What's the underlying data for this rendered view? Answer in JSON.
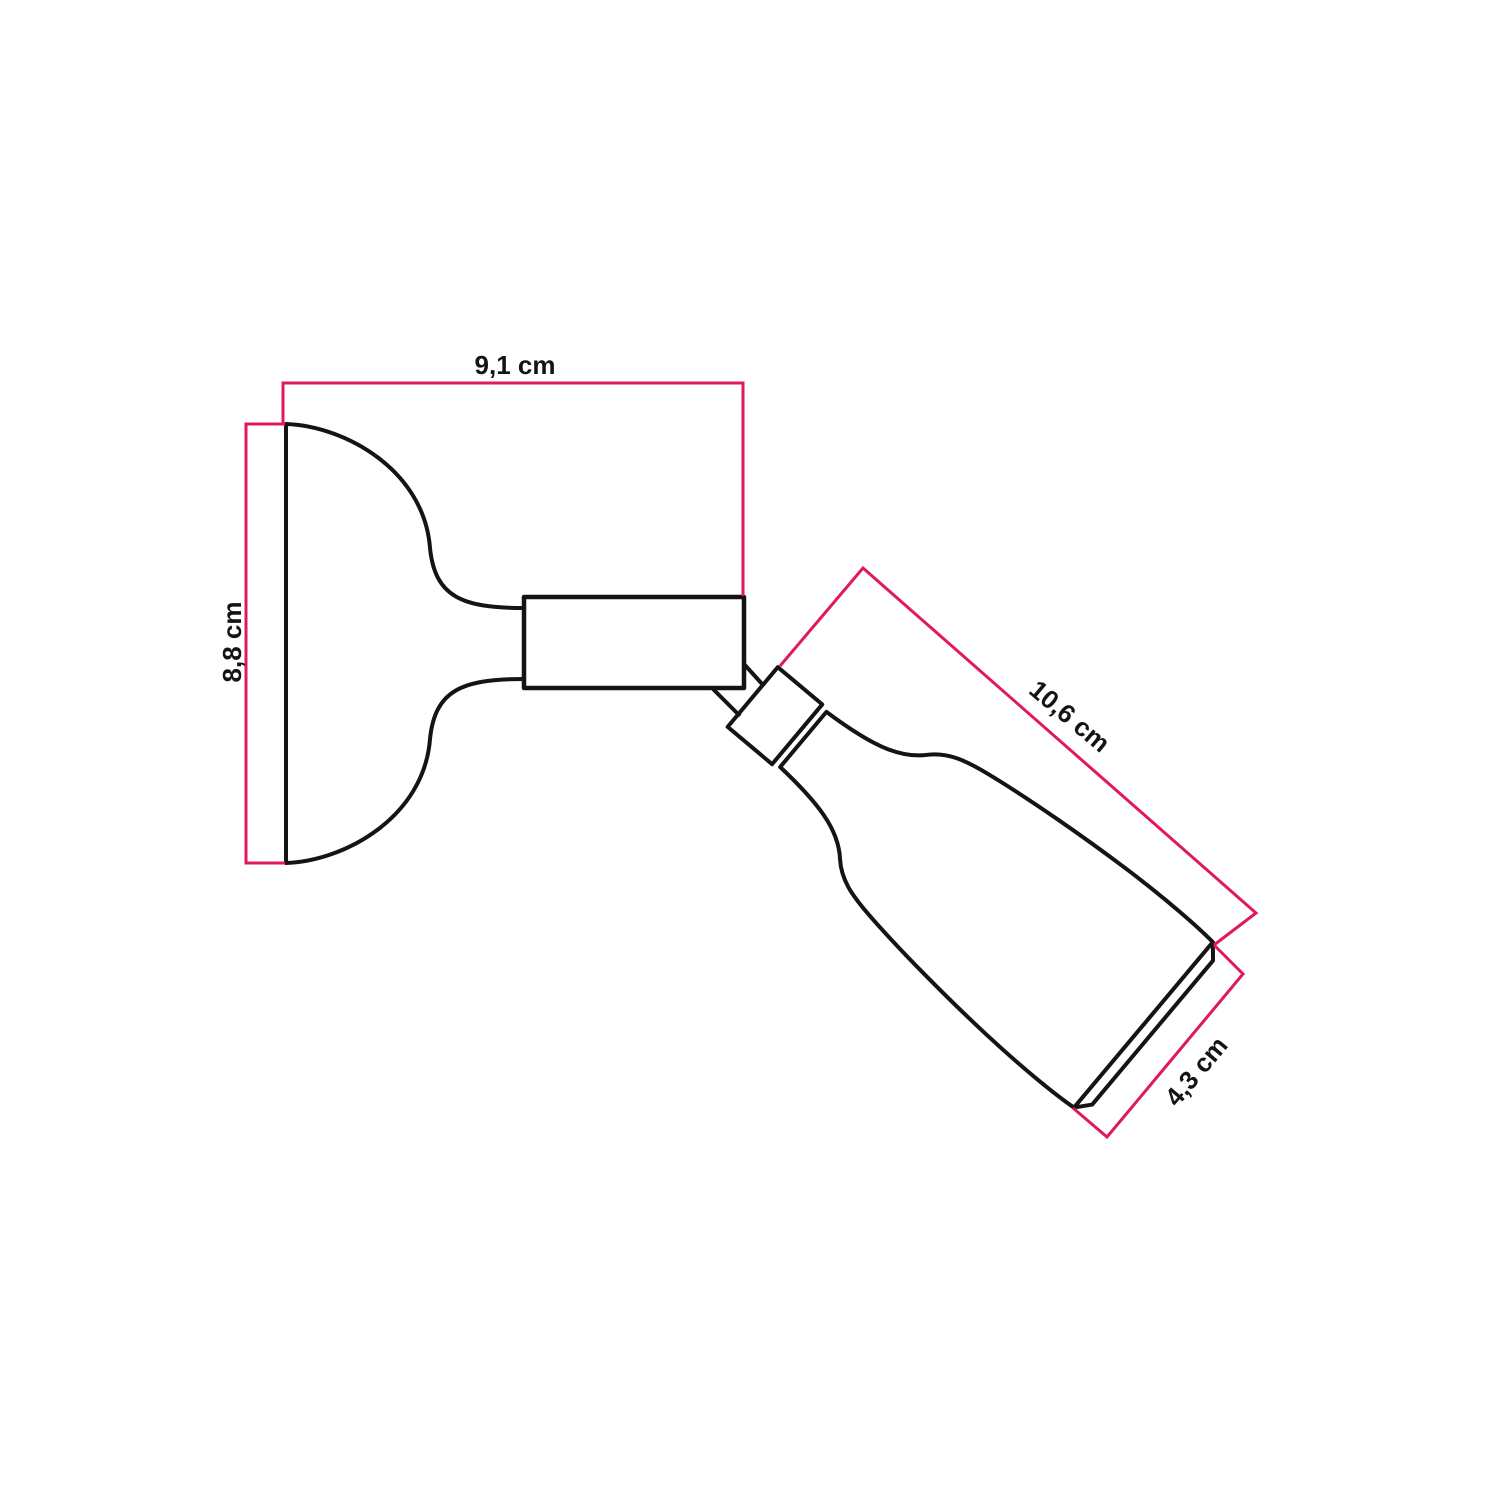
{
  "colors": {
    "ink": "#141414",
    "dimension": "#E0185C",
    "page_background": "#ffffff"
  },
  "diagram": {
    "kind": "product-dimension-diagram",
    "subject": "adjustable wall spotlight with wall cup base and tilted cylindrical lampholder",
    "unit": "cm",
    "dimensions": {
      "top_width_label": "9,1 cm",
      "left_height_label": "8,8 cm",
      "spot_length_label": "10,6 cm",
      "spot_diameter_label": "4,3 cm"
    }
  }
}
